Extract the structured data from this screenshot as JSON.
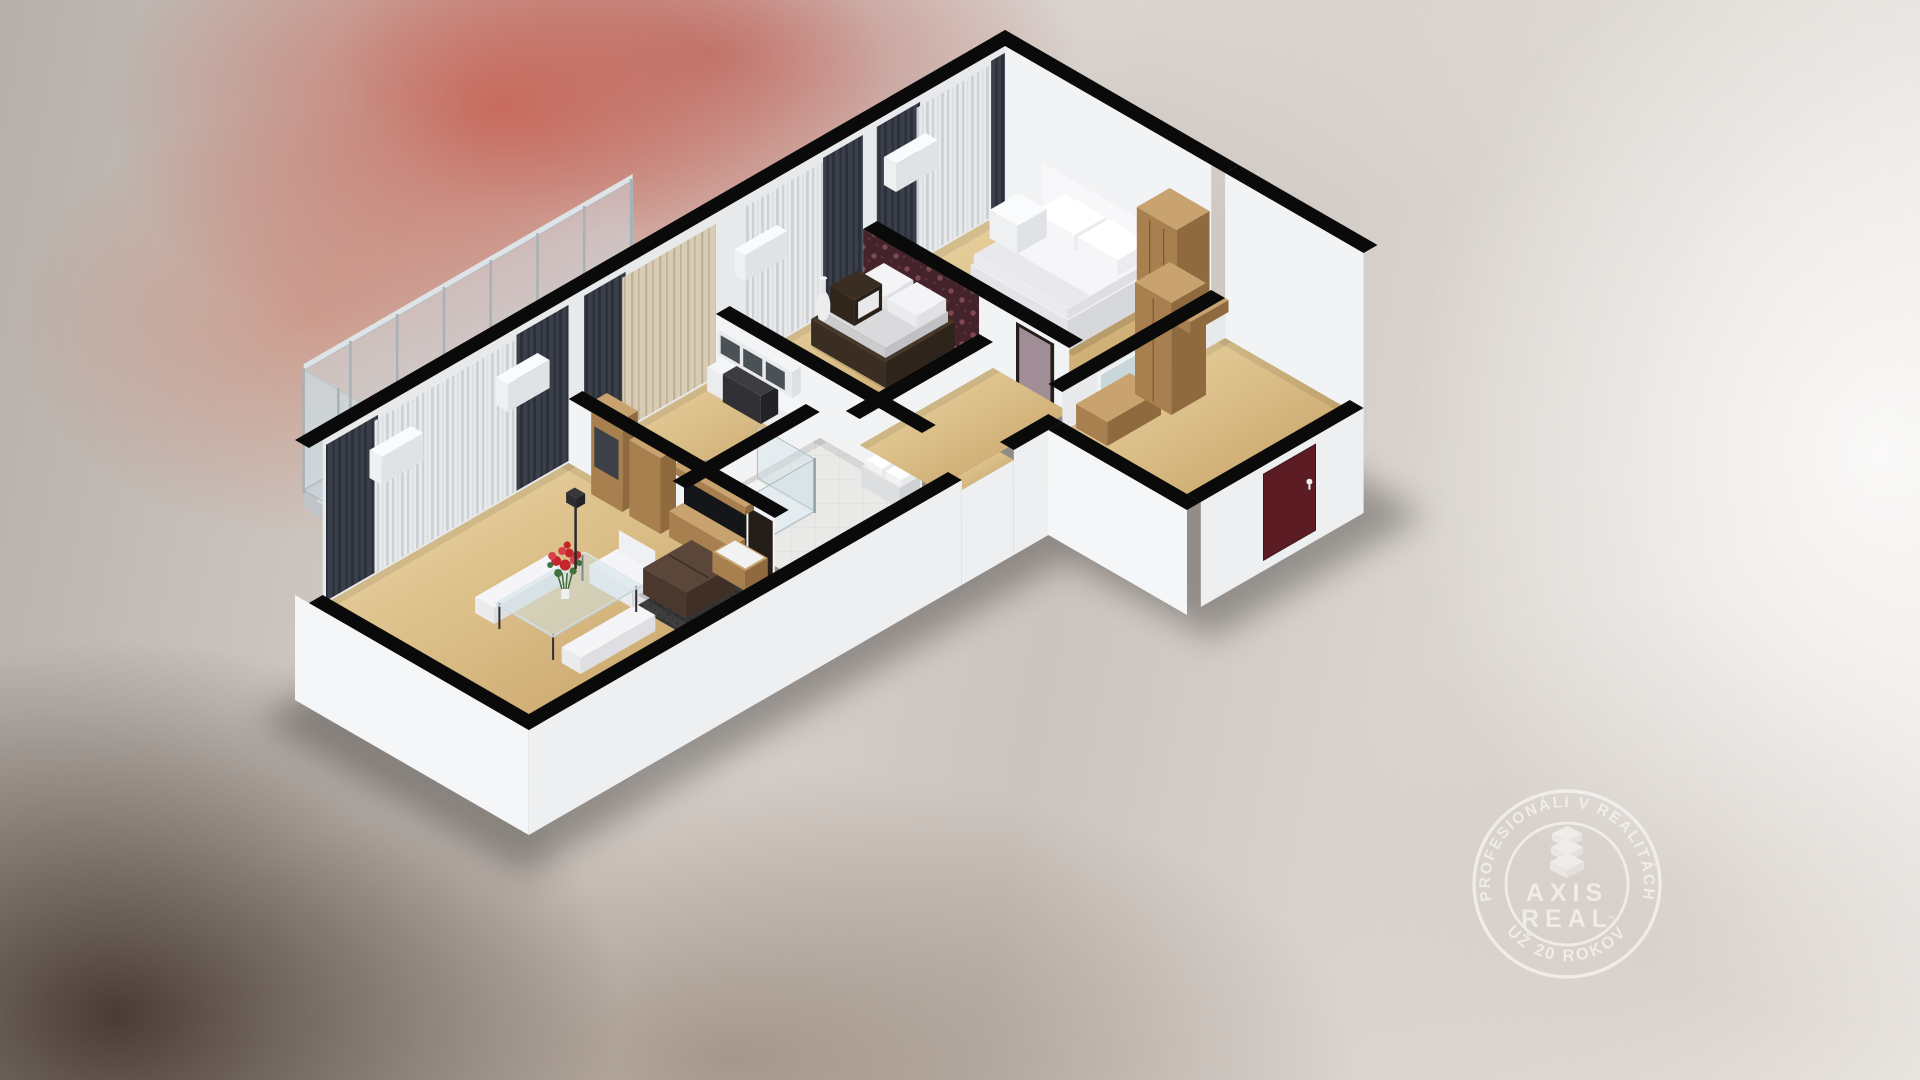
{
  "watermark": {
    "arc_top": "PROFESIONÁLI V REALITÁCH",
    "arc_bottom": "UŽ 20 ROKOV",
    "brand_line1": "AXIS",
    "brand_line2": "REAL",
    "trademark": "™"
  },
  "palette": {
    "floor1": "#eed9a8",
    "floor2": "#c49e62",
    "wall": "#f2f3f4",
    "wallDim": "#e7e9eb",
    "cut": "#0a0a0a",
    "ext": "#edeff1",
    "extSide": "#f5f6f7",
    "sheer1": "#e8e9eb",
    "sheer2": "#cdd0d4",
    "drape1": "#3a3f49",
    "drape2": "#2b303a",
    "cream1": "#d9ccb5",
    "cream2": "#c0b298",
    "damask1": "#45232a",
    "damask2": "#7d4a52",
    "damask3": "#5c3038",
    "glassRail": "#cfe2ea",
    "chrome": "#93a1a8",
    "post": "#a9b1b6",
    "slab": "#d6d8da",
    "slabEdge": "#c1c4c6",
    "oakTop": "#c8a36f",
    "oakFront": "#a87f4e",
    "oakSide": "#8f6a3e",
    "oakLine": "#7a5835",
    "tv": "#141619",
    "door": "#5b1d23",
    "mauve": "#a08d96",
    "sofa1": "#5b463a",
    "sofa2": "#4a382e",
    "sofa3": "#3f2f26",
    "rug1": "#3e3e3e",
    "rug2": "#333333",
    "rose1": "#c1272d",
    "rose2": "#d8404a",
    "leaf": "#41703a",
    "glassTbl": "#cfe3ea",
    "white1": "#fafbfc",
    "white2": "#eef0f2",
    "white3": "#e0e3e6"
  }
}
